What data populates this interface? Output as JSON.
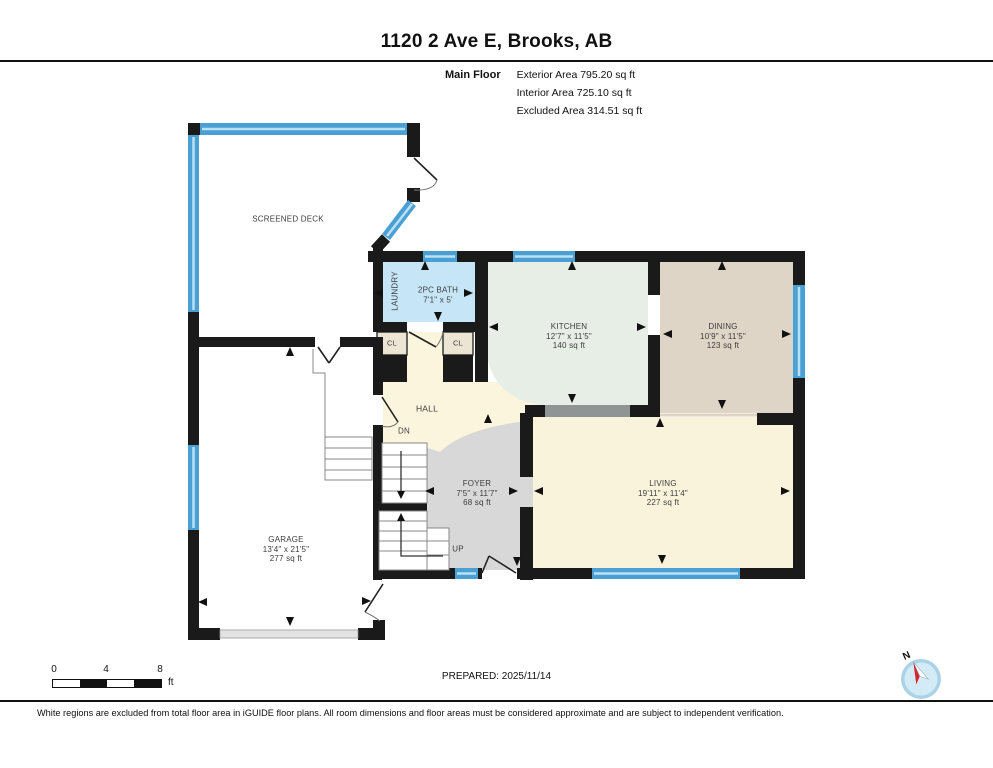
{
  "header": {
    "title": "1120 2 Ave E, Brooks, AB",
    "floor_label": "Main Floor",
    "stats": [
      "Exterior Area 795.20 sq ft",
      "Interior Area 725.10 sq ft",
      "Excluded Area 314.51 sq ft"
    ]
  },
  "rooms": {
    "screened_deck": {
      "name": "SCREENED DECK"
    },
    "laundry": {
      "name": "LAUNDRY"
    },
    "bath": {
      "name": "2PC BATH",
      "dims": "7'1\" x 5'"
    },
    "kitchen": {
      "name": "KITCHEN",
      "dims": "12'7\" x 11'5\"",
      "area": "140 sq ft"
    },
    "dining": {
      "name": "DINING",
      "dims": "10'9\" x 11'5\"",
      "area": "123 sq ft"
    },
    "living": {
      "name": "LIVING",
      "dims": "19'11\" x 11'4\"",
      "area": "227 sq ft"
    },
    "foyer": {
      "name": "FOYER",
      "dims": "7'5\" x 11'7\"",
      "area": "68 sq ft"
    },
    "garage": {
      "name": "GARAGE",
      "dims": "13'4\" x 21'5\"",
      "area": "277 sq ft"
    },
    "hall": {
      "name": "HALL"
    },
    "closet_left": {
      "name": "CL"
    },
    "closet_right": {
      "name": "CL"
    },
    "stairs_down": {
      "label": "DN"
    },
    "stairs_up": {
      "label": "UP"
    }
  },
  "scale_bar": {
    "ticks": [
      "0",
      "4",
      "8"
    ],
    "unit": "ft"
  },
  "compass": {
    "north_label": "N"
  },
  "footer": {
    "prepared": "PREPARED: 2025/11/14",
    "disclaimer": "White regions are excluded from total floor area in iGUIDE floor plans. All room dimensions and floor areas must be considered approximate and are subject to independent verification."
  },
  "colors": {
    "wall": "#1a1a1a",
    "windowBlue": "#4aa0d5",
    "windowLight": "#b9e0f3",
    "bathBlue": "#c6e6f7",
    "kitchenGreen": "#e7eee6",
    "diningBeige": "#ded5c6",
    "livingCream": "#faf3dc",
    "hallCream": "#fcf5de",
    "foyerGray": "#d8d8d8",
    "closetBeige": "#ece5d3",
    "openingGray": "#8f9595",
    "transitionLine": "#ddd4c4",
    "compassRing": "#abd3e8",
    "compassFill": "#d3ebf7",
    "needleRed": "#d6252b"
  }
}
